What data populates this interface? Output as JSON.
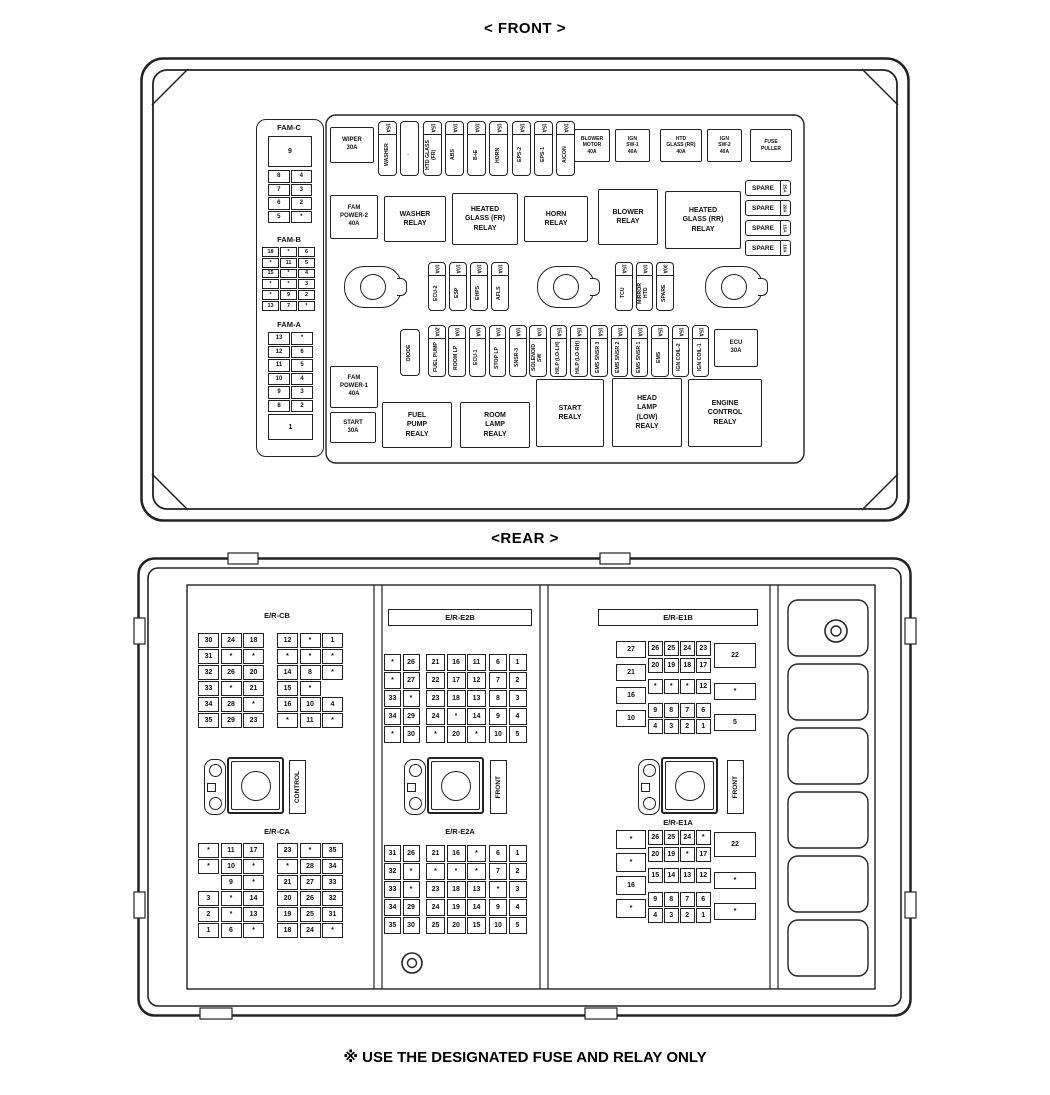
{
  "front": {
    "title": "< FRONT >",
    "fam_c": {
      "label": "FAM-C",
      "big": "9",
      "rows": [
        [
          "8",
          "4"
        ],
        [
          "7",
          "3"
        ],
        [
          "6",
          "2"
        ],
        [
          "5",
          "*"
        ]
      ]
    },
    "fam_b": {
      "label": "FAM-B",
      "rows": [
        [
          "18",
          "*",
          "6"
        ],
        [
          "*",
          "11",
          "5"
        ],
        [
          "15",
          "*",
          "4"
        ],
        [
          "*",
          "*",
          "3"
        ],
        [
          "*",
          "9",
          "2"
        ],
        [
          "13",
          "7",
          "*"
        ]
      ]
    },
    "fam_a": {
      "label": "FAM-A",
      "big": "1",
      "rows": [
        [
          "13",
          "*"
        ],
        [
          "12",
          "6"
        ],
        [
          "11",
          "5"
        ],
        [
          "10",
          "4"
        ],
        [
          "9",
          "3"
        ],
        [
          "8",
          "2"
        ]
      ]
    },
    "boxes": {
      "wiper": "WIPER\n30A",
      "blower_motor": "BLOWER\nMOTOR\n40A",
      "ign_sw1": "IGN\nSW-1\n40A",
      "htd_glass_rr": "HTD\nGLASS (RR)\n40A",
      "ign_sw2": "IGN\nSW-2\n40A",
      "fuse_puller": "FUSE\nPULLER",
      "fam_power2": "FAM\nPOWER-2\n40A",
      "washer_relay": "WASHER\nRELAY",
      "heated_glass_fr_relay": "HEATED\nGLASS (FR)\nRELAY",
      "horn_relay": "HORN\nRELAY",
      "blower_relay": "BLOWER\nRELAY",
      "heated_glass_rr_relay": "HEATED\nGLASS (RR)\nRELAY",
      "ecu_30a": "ECU\n30A",
      "diode": "DIODE",
      "fam_power1": "FAM\nPOWER-1\n40A",
      "start_30a": "START\n30A",
      "fuel_pump_relay": "FUEL\nPUMP\nREALY",
      "room_lamp_relay": "ROOM\nLAMP\nREALY",
      "start_relay": "START\nREALY",
      "head_lamp_low_relay": "HEAD\nLAMP\n(LOW)\nREALY",
      "engine_control_relay": "ENGINE\nCONTROL\nREALY"
    },
    "top_fuses": [
      {
        "amp": "15A",
        "label": "WASHER"
      },
      {
        "amp": "",
        "label": "·"
      },
      {
        "amp": "15A",
        "label": "HTD GLASS (FR)"
      },
      {
        "amp": "10A",
        "label": "ABS"
      },
      {
        "amp": "10A",
        "label": "B+E"
      },
      {
        "amp": "15A",
        "label": "HORN"
      },
      {
        "amp": "15A",
        "label": "EPS-2"
      },
      {
        "amp": "15A",
        "label": "EPS-1"
      },
      {
        "amp": "10A",
        "label": "A/CON"
      }
    ],
    "mid_fuses_left": [
      {
        "amp": "10A",
        "label": "ECU-2"
      },
      {
        "amp": "10A",
        "label": "ESP"
      },
      {
        "amp": "10A",
        "label": "EHPS"
      },
      {
        "amp": "10A",
        "label": "AFLS"
      }
    ],
    "mid_fuses_right": [
      {
        "amp": "15A",
        "label": "TCU"
      },
      {
        "amp": "10A",
        "label": "MIRROR HTD"
      },
      {
        "amp": "30A",
        "label": "SPARE"
      }
    ],
    "low_fuses": [
      {
        "amp": "20A",
        "label": "FUEL PUMP"
      },
      {
        "amp": "10A",
        "label": "ROOM LP"
      },
      {
        "amp": "10A",
        "label": "ECU-1"
      },
      {
        "amp": "10A",
        "label": "STOP LP"
      },
      {
        "amp": "10A",
        "label": "SNSR-3"
      },
      {
        "amp": "10A",
        "label": "SOLENOID SW"
      },
      {
        "amp": "15A",
        "label": "H/LP (LO-LH)"
      },
      {
        "amp": "15A",
        "label": "H/LP (LO-RH)"
      },
      {
        "amp": "15A",
        "label": "EMS SNSR 3"
      },
      {
        "amp": "10A",
        "label": "EMS SNSR 2"
      },
      {
        "amp": "10A",
        "label": "EMS SNSR 1"
      },
      {
        "amp": "15A",
        "label": "EMS"
      },
      {
        "amp": "15A",
        "label": "IGN COIL-2"
      },
      {
        "amp": "15A",
        "label": "IGN COIL-1"
      }
    ],
    "spares": [
      {
        "label": "SPARE",
        "amp": "25A"
      },
      {
        "label": "SPARE",
        "amp": "20A"
      },
      {
        "label": "SPARE",
        "amp": "15A"
      },
      {
        "label": "SPARE",
        "amp": "10A"
      }
    ]
  },
  "rear": {
    "title": "<REAR >",
    "cb": {
      "label": "E/R-CB",
      "left": [
        [
          "30",
          "24",
          "18"
        ],
        [
          "31",
          "*",
          "*"
        ],
        [
          "32",
          "26",
          "20"
        ],
        [
          "33",
          "*",
          "21"
        ],
        [
          "34",
          "28",
          "*"
        ],
        [
          "35",
          "29",
          "23"
        ]
      ],
      "right": [
        [
          "12",
          "*",
          "1"
        ],
        [
          "*",
          "*",
          "*"
        ],
        [
          "14",
          "8",
          "*"
        ],
        [
          "15",
          "*",
          ""
        ],
        [
          "16",
          "10",
          "4"
        ],
        [
          "*",
          "11",
          "*"
        ]
      ]
    },
    "ca": {
      "label": "E/R-CA",
      "left": [
        [
          "*",
          "11",
          "17"
        ],
        [
          "*",
          "10",
          "*"
        ],
        [
          "",
          "9",
          "*"
        ],
        [
          "3",
          "*",
          "14"
        ],
        [
          "2",
          "*",
          "13"
        ],
        [
          "1",
          "6",
          "*"
        ]
      ],
      "right": [
        [
          "23",
          "*",
          "35"
        ],
        [
          "*",
          "28",
          "34"
        ],
        [
          "21",
          "27",
          "33"
        ],
        [
          "20",
          "26",
          "32"
        ],
        [
          "19",
          "25",
          "31"
        ],
        [
          "18",
          "24",
          "*"
        ]
      ]
    },
    "e2b": {
      "label": "E/R-E2B",
      "g1": [
        [
          "*",
          "26"
        ],
        [
          "*",
          "27"
        ],
        [
          "33",
          "*"
        ],
        [
          "34",
          "29"
        ],
        [
          "*",
          "30"
        ]
      ],
      "g2": [
        [
          "21",
          "16",
          "11"
        ],
        [
          "22",
          "17",
          "12"
        ],
        [
          "23",
          "18",
          "13"
        ],
        [
          "24",
          "*",
          "14"
        ],
        [
          "*",
          "20",
          "*"
        ]
      ],
      "g3": [
        [
          "6",
          "1"
        ],
        [
          "7",
          "2"
        ],
        [
          "8",
          "3"
        ],
        [
          "9",
          "4"
        ],
        [
          "10",
          "5"
        ]
      ]
    },
    "e2a": {
      "label": "E/R-E2A",
      "g1": [
        [
          "31",
          "26"
        ],
        [
          "32",
          "*"
        ],
        [
          "33",
          "*"
        ],
        [
          "34",
          "29"
        ],
        [
          "35",
          "30"
        ]
      ],
      "g2": [
        [
          "21",
          "16",
          "*"
        ],
        [
          "*",
          "*",
          "*"
        ],
        [
          "23",
          "18",
          "13"
        ],
        [
          "24",
          "19",
          "14"
        ],
        [
          "25",
          "20",
          "15"
        ]
      ],
      "g3": [
        [
          "6",
          "1"
        ],
        [
          "7",
          "2"
        ],
        [
          "*",
          "3"
        ],
        [
          "9",
          "4"
        ],
        [
          "10",
          "5"
        ]
      ]
    },
    "e1b": {
      "label": "E/R-E1B",
      "left": [
        "27",
        "21",
        "16",
        "10"
      ],
      "mid": [
        [
          "26",
          "25",
          "24",
          "23"
        ],
        [
          "20",
          "19",
          "18",
          "17"
        ],
        [
          "*",
          "*",
          "*",
          "12"
        ],
        [
          "9",
          "8",
          "7",
          "6"
        ],
        [
          "4",
          "3",
          "2",
          "1"
        ]
      ],
      "right": [
        "22",
        "*",
        "5"
      ]
    },
    "e1a": {
      "label": "E/R-E1A",
      "left": [
        "*",
        "*",
        "16",
        "*"
      ],
      "mid": [
        [
          "26",
          "25",
          "24",
          "*"
        ],
        [
          "20",
          "19",
          "*",
          "17"
        ],
        [
          "15",
          "14",
          "13",
          "12"
        ],
        [
          "9",
          "8",
          "7",
          "6"
        ],
        [
          "4",
          "3",
          "2",
          "1"
        ]
      ],
      "right": [
        "22",
        "*",
        "*"
      ]
    },
    "connector_labels": [
      "CONTROL",
      "FRONT",
      "FRONT"
    ]
  },
  "footer": "※ USE THE DESIGNATED FUSE AND RELAY ONLY"
}
